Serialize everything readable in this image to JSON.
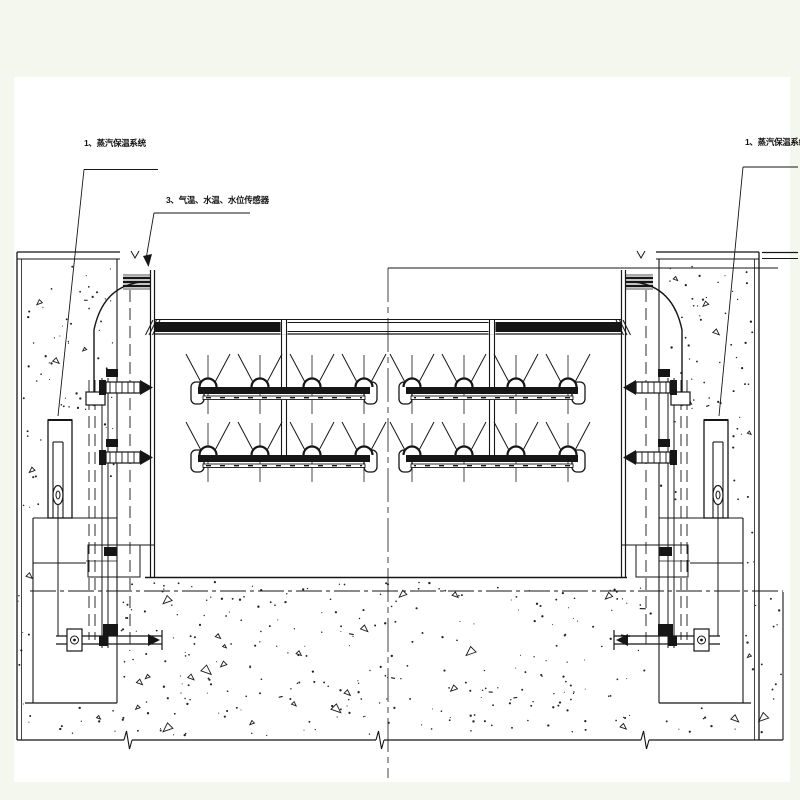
{
  "drawing": {
    "type": "engineering-section-drawing",
    "subject": "gate steam heating and sensor installation section",
    "labels": {
      "steam_left": "1、蒸汽保温系统",
      "steam_right": "1、蒸汽保温系统",
      "sensors": "3、气温、水温、水位传感器"
    },
    "colors": {
      "background": "#f4f7ee",
      "paper": "#ffffff",
      "ink": "#161616"
    }
  }
}
